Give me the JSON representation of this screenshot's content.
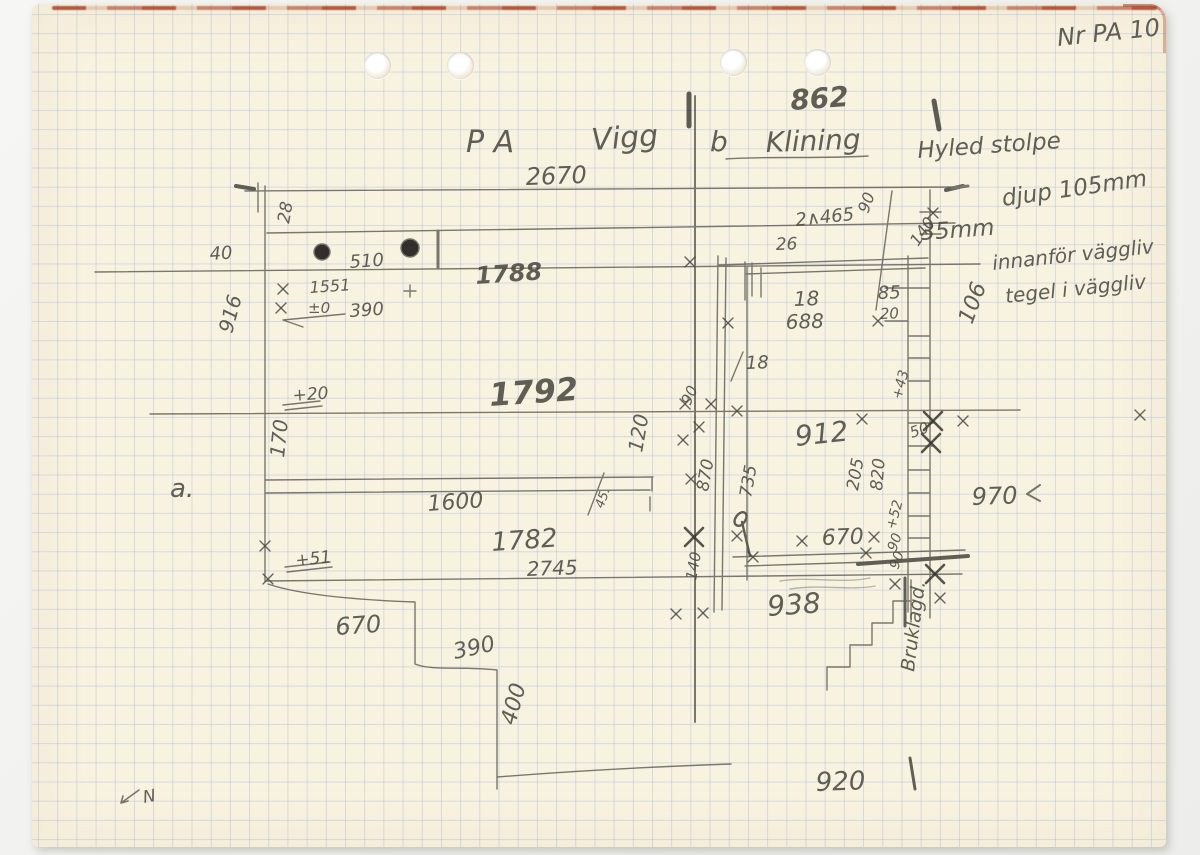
{
  "document": {
    "type": "hand-drawn measurement sketch on graph paper",
    "archive_number": "Nr PA 10",
    "north_label": "N",
    "colors": {
      "paper": "#f8f2e1",
      "grid_blue": "#94adcd",
      "pencil": "#4c4a42",
      "pencil_dark": "#38362f",
      "red_edge": "#a84028"
    }
  },
  "title": {
    "part1": "P A",
    "part2": "Vigg",
    "part3": "b",
    "part4": "Klining"
  },
  "notes": {
    "line1": "Hyled stolpe",
    "line2": "djup 105mm",
    "line3": "35mm",
    "line4": "innanför väggliv",
    "line5": "tegel i väggliv"
  },
  "annotations": [
    {
      "t": "Nr PA 10",
      "x": 1058,
      "y": 46,
      "s": 24,
      "r": -6
    },
    {
      "t": "P A",
      "x": 466,
      "y": 152,
      "s": 30,
      "r": 0
    },
    {
      "t": "Vigg",
      "x": 592,
      "y": 150,
      "s": 30,
      "r": -4
    },
    {
      "t": "b",
      "x": 710,
      "y": 151,
      "s": 28,
      "r": 0
    },
    {
      "t": "Klining",
      "x": 766,
      "y": 152,
      "s": 28,
      "r": -2
    },
    {
      "t": "862",
      "x": 791,
      "y": 110,
      "s": 28,
      "r": -4,
      "w": "b"
    },
    {
      "t": "2670",
      "x": 526,
      "y": 185,
      "s": 24,
      "r": -2
    },
    {
      "t": "Hyled stolpe",
      "x": 918,
      "y": 158,
      "s": 23,
      "r": -4
    },
    {
      "t": "djup 105mm",
      "x": 1003,
      "y": 206,
      "s": 23,
      "r": -8
    },
    {
      "t": "35mm",
      "x": 921,
      "y": 240,
      "s": 23,
      "r": -4
    },
    {
      "t": "innanför väggliv",
      "x": 993,
      "y": 270,
      "s": 20,
      "r": -6
    },
    {
      "t": "tegel i väggliv",
      "x": 1006,
      "y": 303,
      "s": 20,
      "r": -6
    },
    {
      "t": "28",
      "x": 289,
      "y": 224,
      "s": 17,
      "r": -80
    },
    {
      "t": "40",
      "x": 210,
      "y": 260,
      "s": 18,
      "r": -4
    },
    {
      "t": "510",
      "x": 350,
      "y": 268,
      "s": 18,
      "r": -4
    },
    {
      "t": "1788",
      "x": 476,
      "y": 284,
      "s": 24,
      "r": -4,
      "w": "b"
    },
    {
      "t": "1551",
      "x": 310,
      "y": 293,
      "s": 16,
      "r": -4
    },
    {
      "t": "±0",
      "x": 308,
      "y": 313,
      "s": 15,
      "r": 0
    },
    {
      "t": "390",
      "x": 350,
      "y": 317,
      "s": 18,
      "r": -4
    },
    {
      "t": "916",
      "x": 232,
      "y": 334,
      "s": 20,
      "r": -75
    },
    {
      "t": "+20",
      "x": 293,
      "y": 401,
      "s": 17,
      "r": -4
    },
    {
      "t": "1792",
      "x": 490,
      "y": 406,
      "s": 32,
      "r": -4,
      "w": "b"
    },
    {
      "t": "170",
      "x": 284,
      "y": 458,
      "s": 20,
      "r": -84
    },
    {
      "t": "a.",
      "x": 170,
      "y": 497,
      "s": 26,
      "r": 0
    },
    {
      "t": "1600",
      "x": 428,
      "y": 511,
      "s": 22,
      "r": -4
    },
    {
      "t": "45.",
      "x": 603,
      "y": 509,
      "s": 13,
      "r": -70
    },
    {
      "t": "120",
      "x": 642,
      "y": 453,
      "s": 20,
      "r": -80
    },
    {
      "t": "1782",
      "x": 492,
      "y": 551,
      "s": 26,
      "r": -4
    },
    {
      "t": "2745",
      "x": 527,
      "y": 576,
      "s": 20,
      "r": -2
    },
    {
      "t": "+51",
      "x": 296,
      "y": 566,
      "s": 17,
      "r": -6
    },
    {
      "t": "670",
      "x": 336,
      "y": 635,
      "s": 24,
      "r": -4
    },
    {
      "t": "390",
      "x": 455,
      "y": 659,
      "s": 22,
      "r": -12
    },
    {
      "t": "400",
      "x": 515,
      "y": 726,
      "s": 22,
      "r": -75
    },
    {
      "t": "920",
      "x": 816,
      "y": 791,
      "s": 26,
      "r": -2
    },
    {
      "t": "938",
      "x": 768,
      "y": 616,
      "s": 28,
      "r": -4
    },
    {
      "t": "912",
      "x": 796,
      "y": 446,
      "s": 28,
      "r": -6
    },
    {
      "t": "670",
      "x": 822,
      "y": 545,
      "s": 22,
      "r": -2
    },
    {
      "t": "18",
      "x": 794,
      "y": 306,
      "s": 20,
      "r": -2
    },
    {
      "t": "688",
      "x": 786,
      "y": 329,
      "s": 20,
      "r": -2
    },
    {
      "t": "18",
      "x": 746,
      "y": 369,
      "s": 18,
      "r": -2
    },
    {
      "t": "85",
      "x": 878,
      "y": 299,
      "s": 18,
      "r": -2
    },
    {
      "t": "20",
      "x": 880,
      "y": 319,
      "s": 15,
      "r": -2
    },
    {
      "t": "26",
      "x": 776,
      "y": 250,
      "s": 17,
      "r": -2
    },
    {
      "t": "2∧465",
      "x": 796,
      "y": 226,
      "s": 18,
      "r": -6
    },
    {
      "t": "90",
      "x": 868,
      "y": 214,
      "s": 16,
      "r": -70
    },
    {
      "t": "140",
      "x": 918,
      "y": 247,
      "s": 16,
      "r": -55
    },
    {
      "t": "106",
      "x": 972,
      "y": 325,
      "s": 22,
      "r": -70
    },
    {
      "t": "970",
      "x": 972,
      "y": 505,
      "s": 24,
      "r": -2
    },
    {
      "t": "90",
      "x": 690,
      "y": 406,
      "s": 15,
      "r": -65
    },
    {
      "t": "870",
      "x": 708,
      "y": 492,
      "s": 17,
      "r": -80
    },
    {
      "t": "735",
      "x": 751,
      "y": 498,
      "s": 17,
      "r": -80
    },
    {
      "t": "205",
      "x": 858,
      "y": 491,
      "s": 17,
      "r": -80
    },
    {
      "t": "820",
      "x": 882,
      "y": 491,
      "s": 17,
      "r": -85
    },
    {
      "t": "+52",
      "x": 895,
      "y": 530,
      "s": 14,
      "r": -75
    },
    {
      "t": "90",
      "x": 896,
      "y": 552,
      "s": 14,
      "r": -70
    },
    {
      "t": "90",
      "x": 898,
      "y": 570,
      "s": 14,
      "r": -70
    },
    {
      "t": "50",
      "x": 912,
      "y": 438,
      "s": 15,
      "r": -20
    },
    {
      "t": "+43",
      "x": 901,
      "y": 400,
      "s": 14,
      "r": -75
    },
    {
      "t": "140",
      "x": 696,
      "y": 581,
      "s": 15,
      "r": -80
    },
    {
      "t": "Bruklagd.",
      "x": 914,
      "y": 672,
      "s": 19,
      "r": -83
    },
    {
      "t": "N",
      "x": 144,
      "y": 803,
      "s": 17,
      "r": -10
    }
  ],
  "cross_marks": {
    "light": [
      [
        283,
        289
      ],
      [
        281,
        308
      ],
      [
        265,
        546
      ],
      [
        268,
        579
      ],
      [
        690,
        262
      ],
      [
        685,
        404
      ],
      [
        711,
        404
      ],
      [
        737,
        411
      ],
      [
        699,
        427
      ],
      [
        683,
        440
      ],
      [
        862,
        419
      ],
      [
        963,
        421
      ],
      [
        728,
        323
      ],
      [
        878,
        321
      ],
      [
        753,
        557
      ],
      [
        866,
        553
      ],
      [
        802,
        541
      ],
      [
        874,
        537
      ],
      [
        703,
        613
      ],
      [
        676,
        614
      ],
      [
        895,
        584
      ],
      [
        940,
        598
      ],
      [
        1140,
        415
      ],
      [
        933,
        213
      ],
      [
        691,
        479
      ],
      [
        737,
        536
      ]
    ],
    "heavy": [
      [
        933,
        421
      ],
      [
        694,
        537
      ],
      [
        935,
        574
      ],
      [
        931,
        443
      ]
    ]
  },
  "punch_holes": [
    [
      377,
      65
    ],
    [
      460,
      65
    ],
    [
      733,
      62
    ],
    [
      817,
      62
    ]
  ]
}
